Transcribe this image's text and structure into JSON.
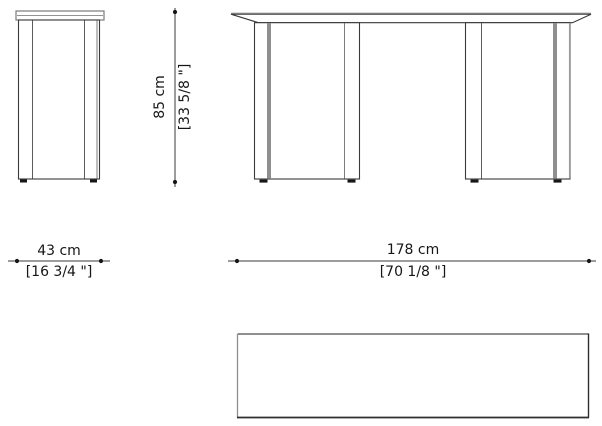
{
  "drawing_type": "furniture-dimension-diagram",
  "views": {
    "side_view": "table-side-elevation",
    "front_view": "table-front-elevation",
    "top_view": "table-plan-outline"
  },
  "dimensions": {
    "height": {
      "metric": "85 cm",
      "imperial": "[33 5/8 \"]"
    },
    "depth": {
      "metric": "43 cm",
      "imperial": "[16 3/4 \"]"
    },
    "width": {
      "metric": "178 cm",
      "imperial": "[70 1/8 \"]"
    }
  },
  "colors": {
    "background": "#ffffff",
    "line_dark": "#3a3a3a",
    "line_gray": "#8f8f8f",
    "feet_black": "#161616",
    "text": "#161616"
  }
}
